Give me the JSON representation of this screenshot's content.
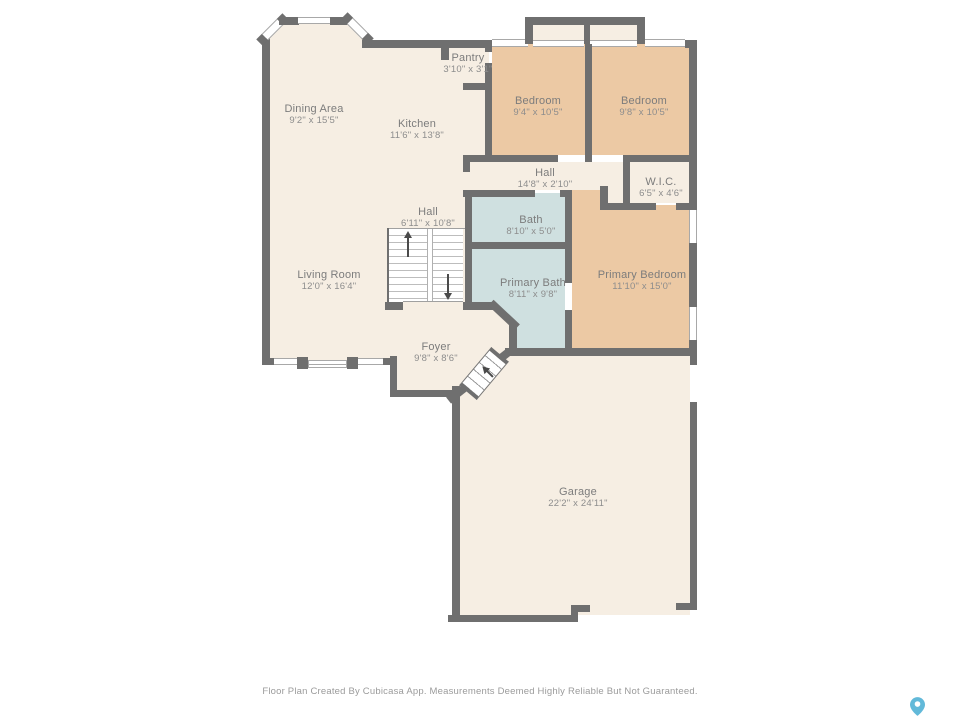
{
  "colors": {
    "wall": "#6f6f6f",
    "room_cream": "#f6eee3",
    "room_tan": "#ecc9a4",
    "room_blue": "#cfe0e0",
    "pin_blue": "#62b9d9"
  },
  "rooms": [
    {
      "name": "Dining Area",
      "dims": "9'2\" x 15'5\""
    },
    {
      "name": "Kitchen",
      "dims": "11'6\" x 13'8\""
    },
    {
      "name": "Pantry",
      "dims": "3'10\" x 3'1\""
    },
    {
      "name": "Bedroom",
      "dims": "9'4\" x 10'5\""
    },
    {
      "name": "Bedroom",
      "dims": "9'8\" x 10'5\""
    },
    {
      "name": "Hall",
      "dims": "14'8\" x 2'10\""
    },
    {
      "name": "W.I.C.",
      "dims": "6'5\" x 4'6\""
    },
    {
      "name": "Hall",
      "dims": "6'11\" x 10'8\""
    },
    {
      "name": "Bath",
      "dims": "8'10\" x 5'0\""
    },
    {
      "name": "Primary Bath",
      "dims": "8'11\" x 9'8\""
    },
    {
      "name": "Primary Bedroom",
      "dims": "11'10\" x 15'0\""
    },
    {
      "name": "Living Room",
      "dims": "12'0\" x 16'4\""
    },
    {
      "name": "Foyer",
      "dims": "9'8\" x 8'6\""
    },
    {
      "name": "Garage",
      "dims": "22'2\" x 24'11\""
    }
  ],
  "footer": {
    "disclaimer": "Floor Plan Created By Cubicasa App. Measurements Deemed Highly Reliable But Not Guaranteed."
  }
}
